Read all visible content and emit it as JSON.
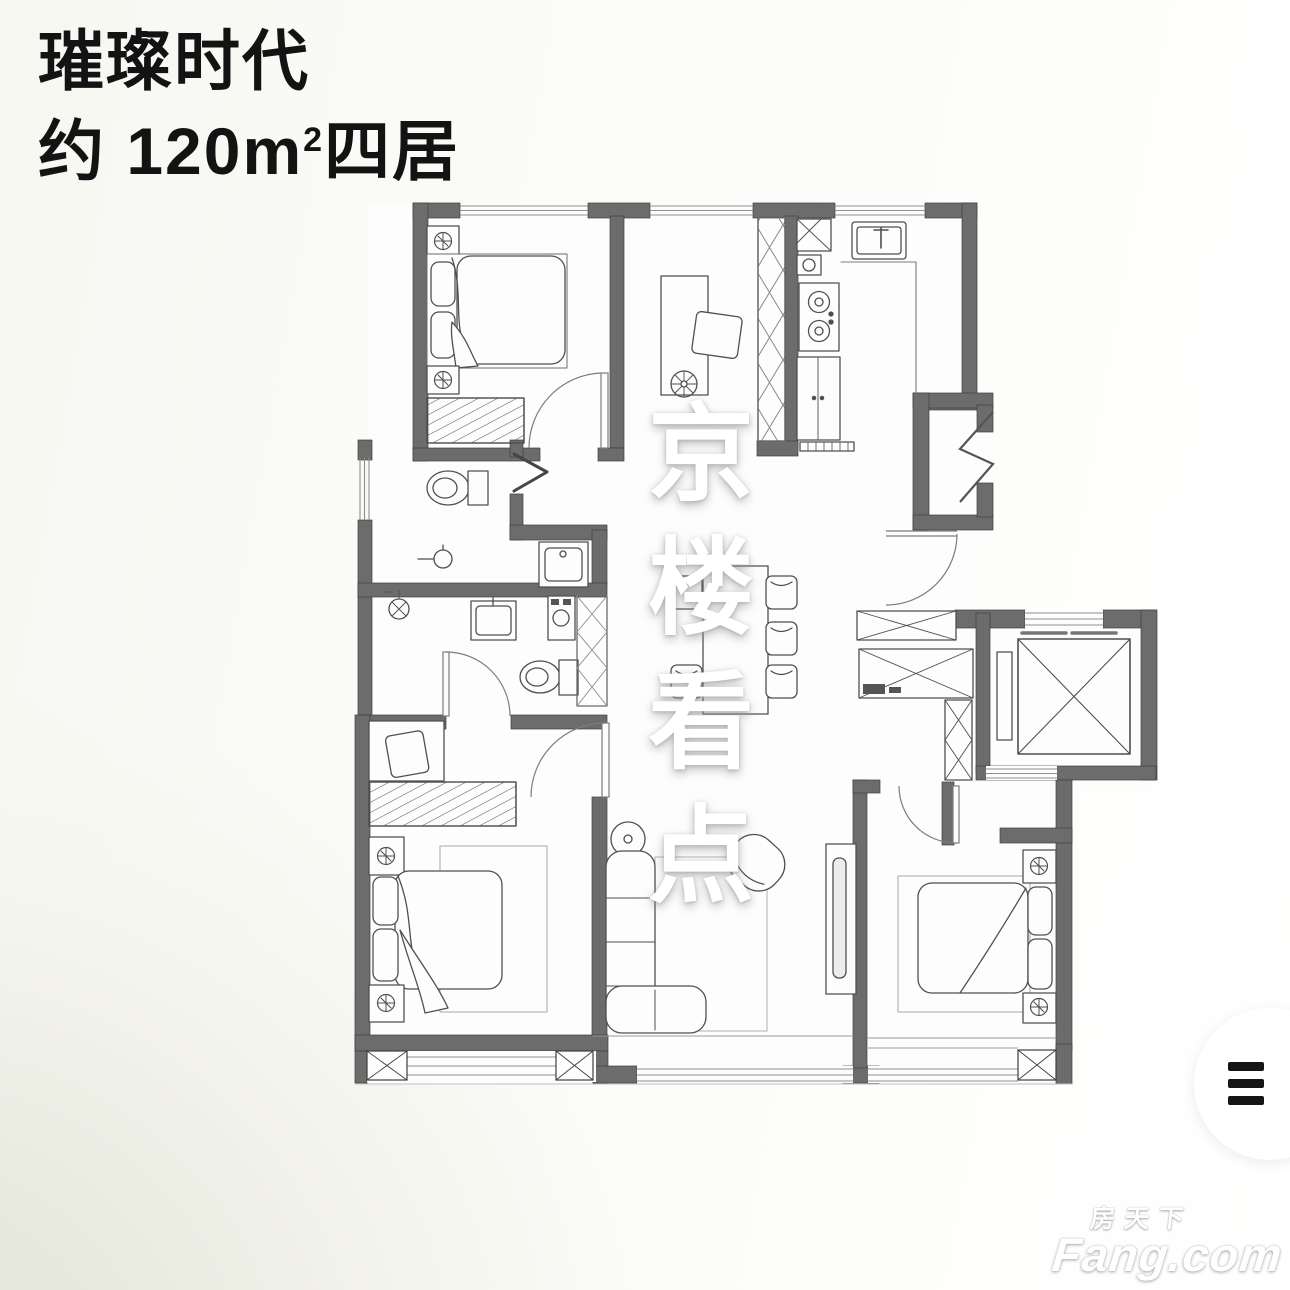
{
  "header": {
    "title": "璀璨时代",
    "subtitle_prefix": "约 120m",
    "subtitle_sup": "2",
    "subtitle_suffix": "四居"
  },
  "center_watermark": {
    "chars": [
      "京",
      "楼",
      "看",
      "点"
    ]
  },
  "brand_watermark": {
    "cn": "房天下",
    "en": "Fang.com"
  },
  "menu_fab": {
    "icon": "hamburger-menu-icon"
  },
  "plan_style": {
    "wall_color": "#6c6c6c",
    "furniture_line": "#4f4f4f",
    "window_line": "#8f8f8f",
    "floor_fill": "#fdfdfd"
  }
}
